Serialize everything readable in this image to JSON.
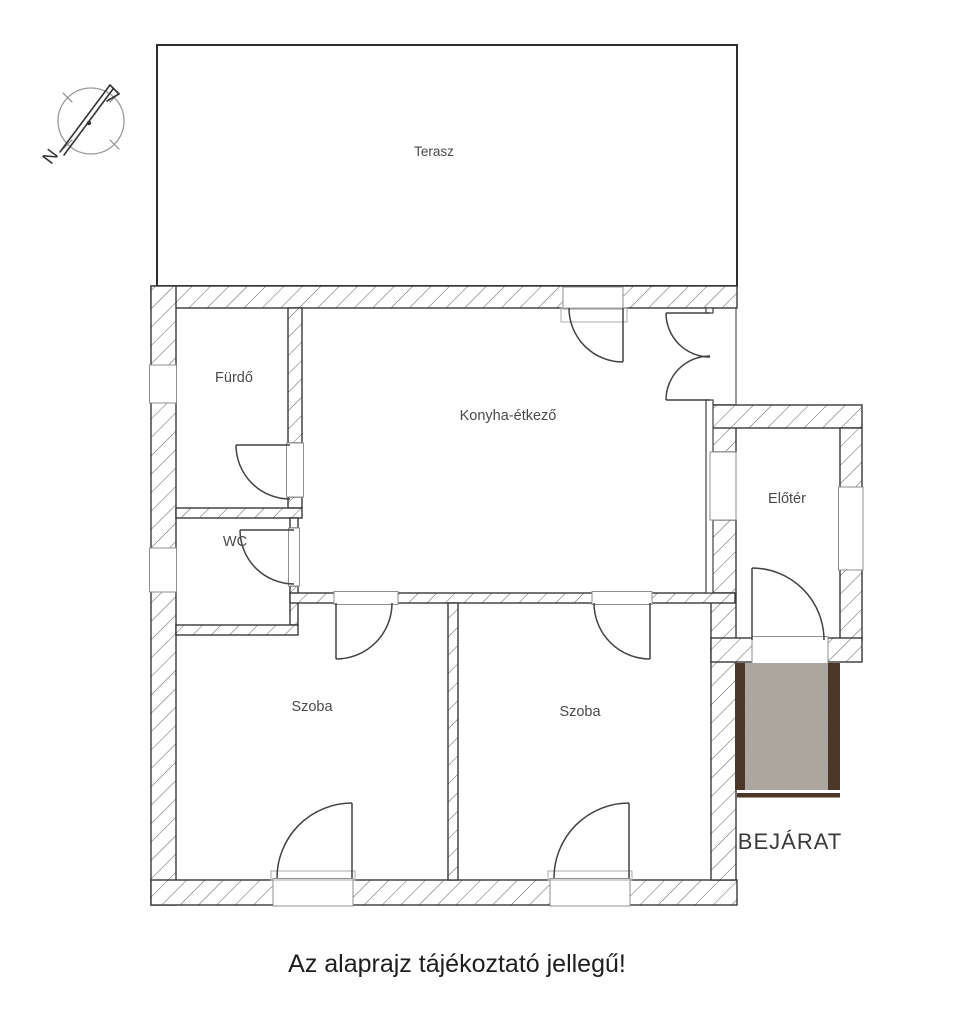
{
  "page": {
    "caption": "Az alaprajz tájékoztató jellegű!"
  },
  "floorplan": {
    "rooms": [
      {
        "id": "terasz",
        "label": "Terasz"
      },
      {
        "id": "furdo",
        "label": "Fürdő"
      },
      {
        "id": "konyha-etkezo",
        "label": "Konyha-étkező"
      },
      {
        "id": "wc",
        "label": "WC"
      },
      {
        "id": "eloter",
        "label": "Előtér"
      },
      {
        "id": "szoba-1",
        "label": "Szoba"
      },
      {
        "id": "szoba-2",
        "label": "Szoba"
      }
    ],
    "entrance_label": "BEJÁRAT",
    "compass": {
      "icon": "compass-north-icon",
      "letter": "N"
    },
    "colors": {
      "wall_outline": "#383838",
      "hatch_line": "#5e5e5e",
      "door_line": "#424242",
      "entrance_wood": "#4b3829",
      "entrance_pad": "#aba49c",
      "label_text": "#4a4a4a",
      "caption_text": "#1e1e1e"
    }
  }
}
